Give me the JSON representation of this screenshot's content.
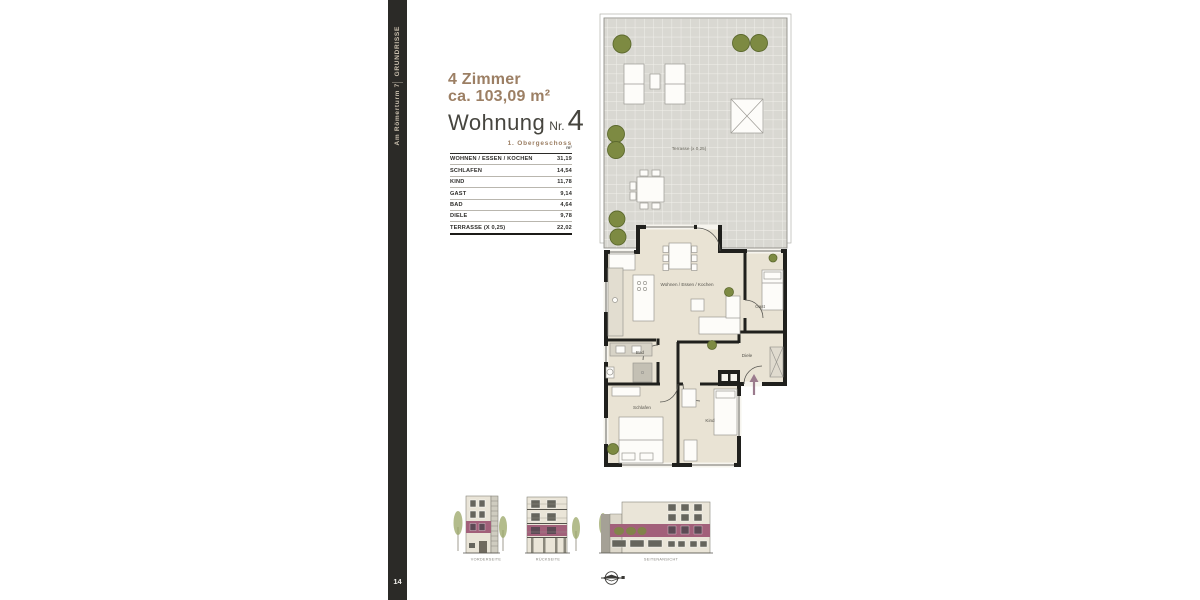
{
  "sidebar": {
    "section_label": "GRUNDRISSE",
    "project_label": "Am Römerturm 7",
    "page_number": "14",
    "background": "#2B2A27",
    "text_color": "#C9BFAE"
  },
  "header": {
    "rooms_line": "4 Zimmer",
    "area_line": "ca. 103,09 m²",
    "unit_word": "Wohnung",
    "unit_nr_prefix": "Nr.",
    "unit_number": "4",
    "floor_label": "1. Obergeschoss",
    "accent_color": "#9C7F64"
  },
  "area_table": {
    "unit_header": "m²",
    "rows": [
      {
        "label": "WOHNEN / ESSEN / KOCHEN",
        "value": "31,19"
      },
      {
        "label": "SCHLAFEN",
        "value": "14,54"
      },
      {
        "label": "KIND",
        "value": "11,78"
      },
      {
        "label": "GAST",
        "value": "9,14"
      },
      {
        "label": "BAD",
        "value": "4,64"
      },
      {
        "label": "DIELE",
        "value": "9,78"
      },
      {
        "label": "TERRASSE (X 0,25)",
        "value": "22,02"
      }
    ]
  },
  "floor_plan": {
    "terrace_label": "Terrasse (x 0,25)",
    "room_labels": {
      "living": "Wohnen / Essen / Kochen",
      "guest": "Gast",
      "bath": "Bad",
      "hall": "Diele",
      "sleep": "Schlafen",
      "child": "Kind"
    },
    "colors": {
      "floor": "#E9E3D4",
      "terrace": "#D9D8D2",
      "wall": "#20201D",
      "plant_green": "#7D8A42",
      "entry_arrow": "#9B7B8D"
    }
  },
  "elevations": {
    "highlight_color": "#A2607A",
    "items": [
      {
        "label": "VORDERSEITE"
      },
      {
        "label": "RÜCKSEITE"
      },
      {
        "label": "SEITENANSICHT"
      }
    ]
  },
  "icons": {
    "compass": "north-arrow-icon"
  }
}
